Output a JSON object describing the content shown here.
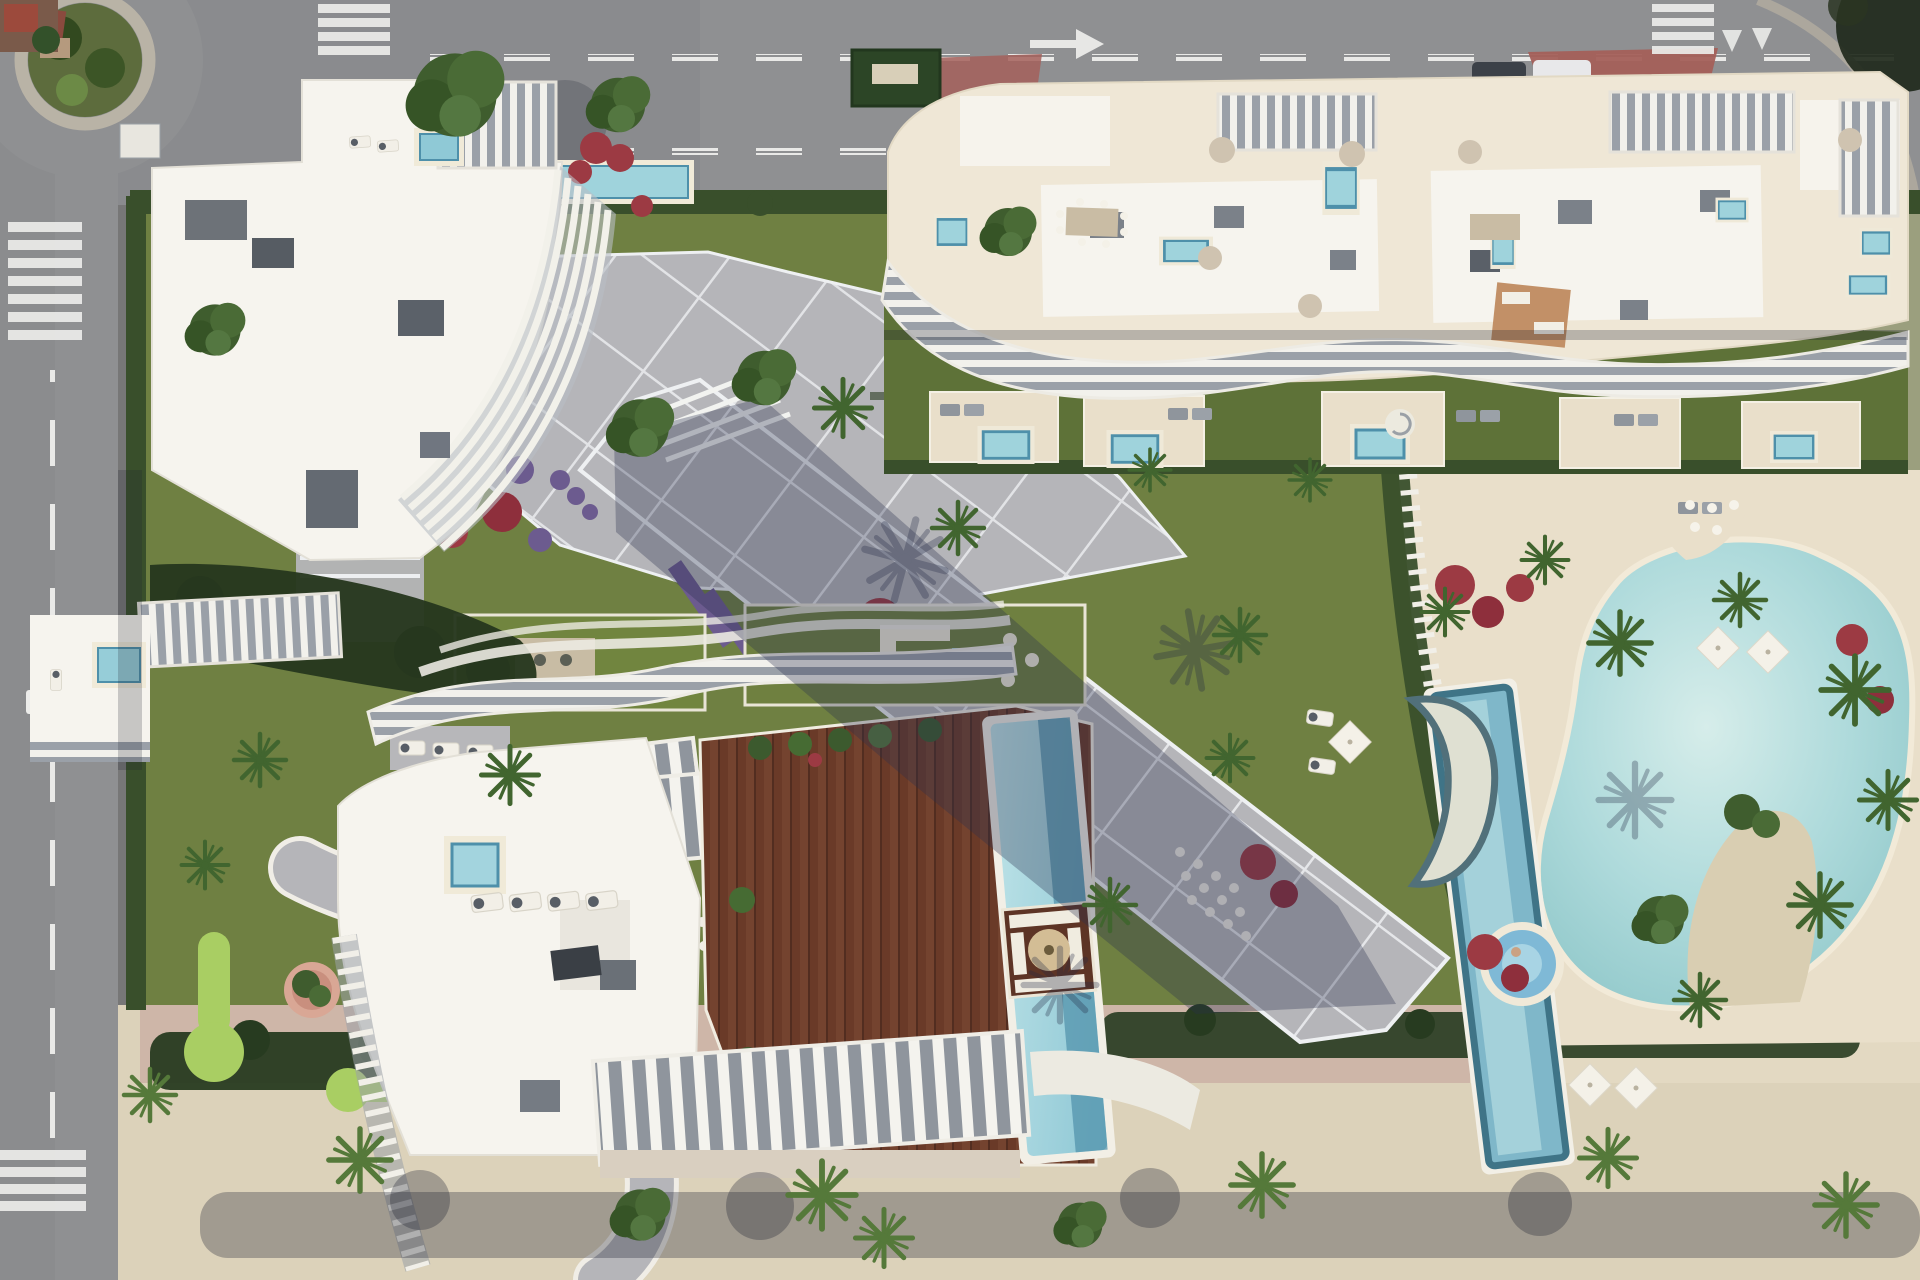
{
  "meta": {
    "description": "Aerial architectural render of a seafront residential complex: three white apartment buildings with curved louvre balconies, rooftop terraces with plunge pools, a central paved walkway, gardens with palms and red and purple flower beds, a mini-golf lawn, a timber roof deck with pool, and a large lagoon pool area with lap pool and kids pool, bounded by roads with crosswalks and a beach promenade."
  },
  "scene": {
    "type": "aerial-render",
    "buildings": [
      {
        "id": "building-a",
        "position": "north-west",
        "style": "white roof, curved vertical louvre balconies, rooftop plant boxes"
      },
      {
        "id": "building-b",
        "position": "north-east",
        "style": "long cream rooftop terraces, pergola slats, wavy louvre south edge, private plunge pools"
      },
      {
        "id": "building-c",
        "position": "south-centre",
        "style": "wavy louvre crown, white roof wing, timber deck wing with rooftop pool and sunken lounge"
      }
    ],
    "pools": {
      "lagoon_pool": 1,
      "lap_pool": 1,
      "kids_round_pool": 1,
      "rooftop_deck_pool": 1,
      "small_private_plunge_pools": 12
    },
    "roads": {
      "north": "dual carriageway, dashed lane lines, white arrow, brick-red junction patches",
      "west": "street with two zebra crossings and roundabout at north-west corner",
      "south": "sand-coloured promenade with palm trees and long hedge shadows"
    },
    "landscape": [
      "lawns",
      "clipped hedges",
      "palm trees",
      "red bougainvillea beds",
      "purple flower drifts",
      "mini-golf putting greens",
      "grey paved plaza with white joint grid"
    ]
  },
  "palette": {
    "road": "#8F9092",
    "roaddark": "#85868A",
    "marking": "#ECECEA",
    "brick": "#A4605A",
    "promenade": "#DCD2BA",
    "pinkpath": "#CBB2A4",
    "pinkroad": "#C2A49B",
    "lawn": "#6F8042",
    "lawndark": "#5E7238",
    "green2": "#A9CE63",
    "hedge": "#394F2B",
    "hedgedark": "#273B20",
    "plaza": "#B5B5B9",
    "plazaline": "#EDEFF1",
    "deck": "#E9DFCA",
    "cream": "#EFE7D6",
    "bldg": "#F6F4EE",
    "slatgray": "#9AA0A8",
    "boxgray": "#6A7077",
    "wood": "#74432F",
    "poolmid": "#9FD3DC",
    "pooldeep": "#4E90AA",
    "sand": "#D9CEB2",
    "flred": "#9C3A43",
    "flpurple": "#6C5B8F"
  }
}
